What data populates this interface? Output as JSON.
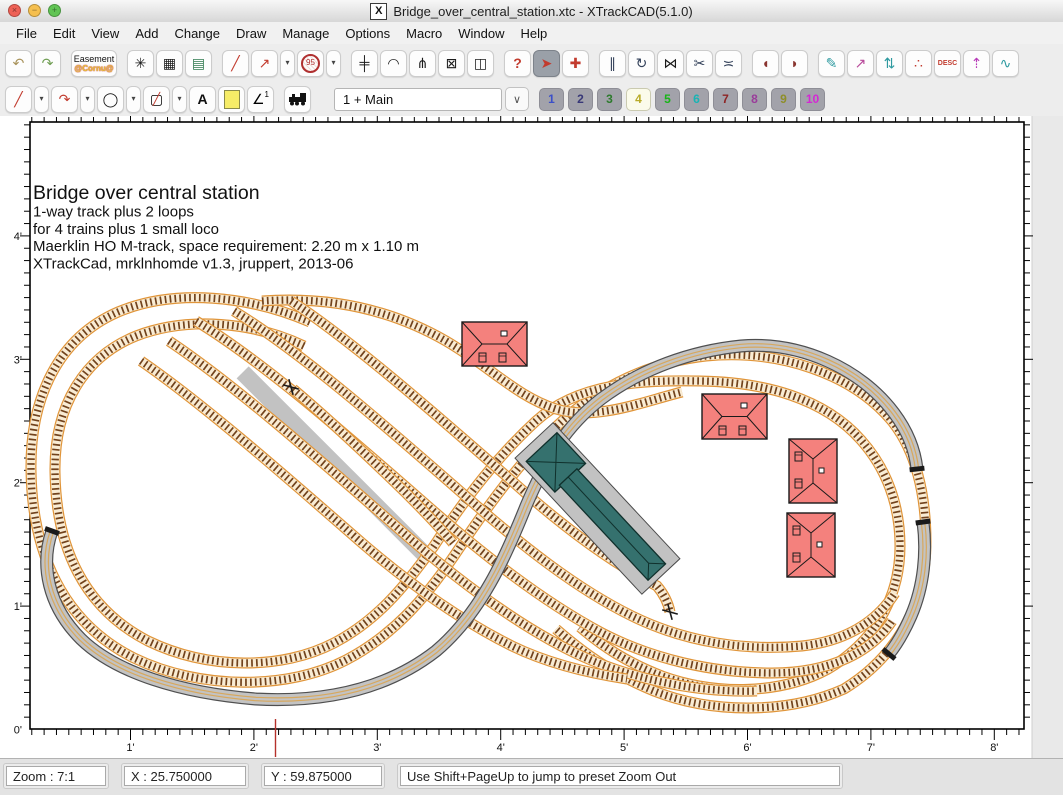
{
  "window": {
    "title": "Bridge_over_central_station.xtc - XTrackCAD(5.1.0)",
    "app_icon": "X",
    "lights": [
      {
        "name": "close-button",
        "color": "#ee6156",
        "glyph": "×"
      },
      {
        "name": "minimize-button",
        "color": "#f5bf4f",
        "glyph": "−"
      },
      {
        "name": "zoom-button",
        "color": "#61c454",
        "glyph": "+"
      }
    ]
  },
  "menu": [
    "File",
    "Edit",
    "View",
    "Add",
    "Change",
    "Draw",
    "Manage",
    "Options",
    "Macro",
    "Window",
    "Help"
  ],
  "toolbar_top": {
    "buttons": [
      {
        "name": "undo-icon",
        "glyph": "↶",
        "color": "#a8925a"
      },
      {
        "name": "redo-icon",
        "glyph": "↷",
        "color": "#6f9e52"
      },
      {
        "type": "gap"
      },
      {
        "name": "easement-button",
        "type": "easement",
        "label": "Easement",
        "sublabel": "@Cornu@"
      },
      {
        "type": "gap"
      },
      {
        "name": "snap-grid-icon",
        "glyph": "✳",
        "color": "#1a1a1a"
      },
      {
        "name": "grid-icon",
        "glyph": "▦",
        "color": "#1a1a1a"
      },
      {
        "name": "map-icon",
        "glyph": "▤",
        "color": "#2f7a4f"
      },
      {
        "type": "gap"
      },
      {
        "name": "ruler-icon",
        "glyph": "╱",
        "color": "#c23b2e"
      },
      {
        "name": "measure-icon",
        "glyph": "↗",
        "color": "#c23b2e"
      },
      {
        "name": "ruler-options-dropdown",
        "type": "dd",
        "glyph": "▾"
      },
      {
        "name": "circle-radius-button",
        "type": "circle95",
        "label": "95"
      },
      {
        "name": "circle-options-dropdown",
        "type": "dd",
        "glyph": "▾"
      },
      {
        "type": "gap"
      },
      {
        "name": "straight-track-icon",
        "glyph": "╪",
        "color": "#1a1a1a"
      },
      {
        "name": "track-cascade-icon",
        "glyph": "◠",
        "color": "#1a1a1a"
      },
      {
        "name": "turnout-icon",
        "glyph": "⋔",
        "color": "#1a1a1a"
      },
      {
        "name": "box-track-icon",
        "glyph": "⊠",
        "color": "#1a1a1a"
      },
      {
        "name": "signal-icon",
        "glyph": "◫",
        "color": "#1a1a1a"
      },
      {
        "type": "gap"
      },
      {
        "name": "describe-icon",
        "glyph": "?",
        "color": "#c23b2e",
        "bold": true
      },
      {
        "name": "select-icon",
        "glyph": "➤",
        "color": "#c23b2e",
        "active": true
      },
      {
        "name": "move-icon",
        "glyph": "✚",
        "color": "#c23b2e"
      },
      {
        "type": "gap"
      },
      {
        "name": "parallel-track-icon",
        "glyph": "∥",
        "color": "#33415a"
      },
      {
        "name": "rotate-icon",
        "glyph": "↻",
        "color": "#33415a"
      },
      {
        "name": "flip-icon",
        "glyph": "⋈",
        "color": "#1a1a1a"
      },
      {
        "name": "split-icon",
        "glyph": "✂",
        "color": "#33415a"
      },
      {
        "name": "join-icon",
        "glyph": "≍",
        "color": "#33415a"
      },
      {
        "type": "gap"
      },
      {
        "name": "tunnel-icon",
        "glyph": "◖",
        "color": "#8a3530"
      },
      {
        "name": "bridge-icon",
        "glyph": "◗",
        "color": "#8a3530"
      },
      {
        "type": "gap"
      },
      {
        "name": "connect-track-icon",
        "glyph": "✎",
        "color": "#2e9aa0"
      },
      {
        "name": "link-icon",
        "glyph": "↗",
        "color": "#b84a9a"
      },
      {
        "name": "elevation-icon",
        "glyph": "⇅",
        "color": "#2e9aa0"
      },
      {
        "name": "scatter-icon",
        "glyph": "∴",
        "color": "#c23b2e"
      },
      {
        "name": "description-button",
        "type": "desc",
        "label": "DESC"
      },
      {
        "name": "profile-arrow-icon",
        "glyph": "⇡",
        "color": "#b83ab8"
      },
      {
        "name": "profile-icon",
        "glyph": "∿",
        "color": "#2e9aa0"
      }
    ]
  },
  "toolbar_draw": {
    "buttons": [
      {
        "name": "draw-line-icon",
        "glyph": "╱",
        "color": "#c23b2e"
      },
      {
        "name": "line-options-dropdown",
        "type": "dd",
        "glyph": "▾"
      },
      {
        "name": "draw-curve-icon",
        "glyph": "↷",
        "color": "#c23b2e"
      },
      {
        "name": "curve-options-dropdown",
        "type": "dd",
        "glyph": "▾"
      },
      {
        "name": "draw-circle-icon",
        "glyph": "◯",
        "color": "#1a1a1a"
      },
      {
        "name": "circle-draw-dropdown",
        "type": "dd",
        "glyph": "▾"
      },
      {
        "name": "draw-box-icon",
        "type": "boxslash",
        "glyph": "▢",
        "overlay": "╱"
      },
      {
        "name": "box-options-dropdown",
        "type": "dd",
        "glyph": "▾"
      },
      {
        "name": "text-tool-icon",
        "glyph": "A",
        "color": "#111111",
        "bold": true
      },
      {
        "name": "note-tool-icon",
        "type": "note"
      },
      {
        "name": "dimension-icon",
        "type": "dim",
        "glyph": "∠",
        "sup": "1"
      },
      {
        "type": "gap"
      },
      {
        "name": "train-tool-icon",
        "type": "train"
      },
      {
        "type": "bigGap"
      }
    ]
  },
  "layers": {
    "selector_value": "1 + Main",
    "chevron": "∨",
    "buttons": [
      {
        "label": "1",
        "color": "#3c50c8"
      },
      {
        "label": "2",
        "color": "#383878"
      },
      {
        "label": "3",
        "color": "#2c7a2c"
      },
      {
        "label": "4",
        "color": "#b8ab28",
        "active": true
      },
      {
        "label": "5",
        "color": "#18b418"
      },
      {
        "label": "6",
        "color": "#18b4b4"
      },
      {
        "label": "7",
        "color": "#8e2424"
      },
      {
        "label": "8",
        "color": "#9a3c9a"
      },
      {
        "label": "9",
        "color": "#8e8e28"
      },
      {
        "label": "10",
        "color": "#d428d4"
      }
    ]
  },
  "canvas": {
    "annotation": {
      "title": "Bridge over central station",
      "lines": [
        "1-way track plus 2 loops",
        "for 4 trains plus 1 small loco",
        "Maerklin HO M-track, space requirement: 2.20 m x 1.10 m",
        "XTrackCad, mrklnhomde v1.3, jruppert, 2013-06"
      ]
    },
    "rulers": {
      "left": [
        "4'",
        "3'",
        "2'",
        "1'",
        "0'"
      ],
      "bottom": [
        "1'",
        "2'",
        "3'",
        "4'",
        "5'",
        "6'",
        "7'",
        "8'"
      ]
    },
    "colors": {
      "track_ballast": "#e0953a",
      "track_fill": "#f9ecd4",
      "track_ties": "#71421c",
      "bridge_gray": "#c3c3c3",
      "bridge_edge": "#4f4f4f",
      "bridge_rail": "#d7a85e",
      "building_red": "#f4817d",
      "station_teal": "#35716e",
      "platform_gray": "#c2c2c2",
      "marker_red": "#b5312c"
    }
  },
  "statusbar": {
    "zoom": "Zoom : 7:1",
    "x": "X : 25.750000",
    "y": "Y : 59.875000",
    "message": "Use Shift+PageUp to jump to preset Zoom Out"
  }
}
